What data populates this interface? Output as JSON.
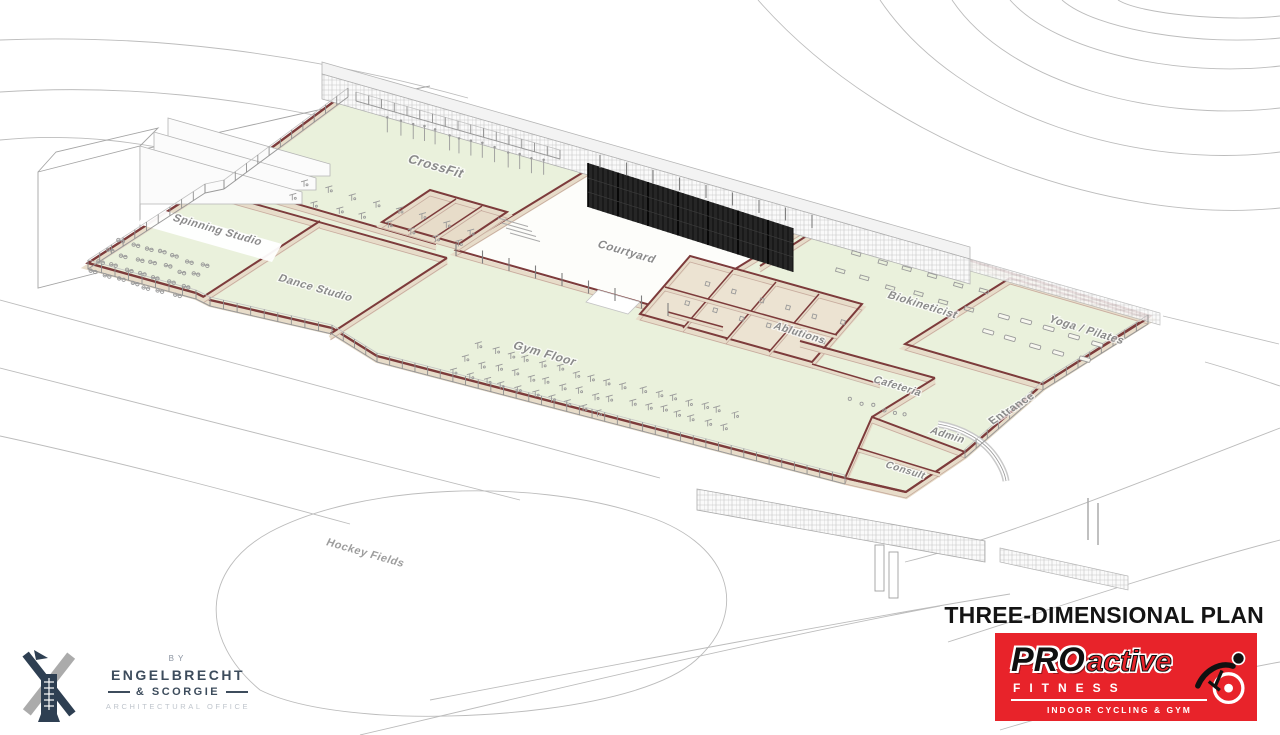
{
  "title_block": {
    "title": "THREE-DIMENSIONAL PLAN"
  },
  "brand": {
    "name_bold": "PRO",
    "name_light": "active",
    "line2": "FITNESS",
    "tagline": "INDOOR CYCLING & GYM",
    "bg_color": "#e8232a"
  },
  "architect": {
    "pre": "BY",
    "line1": "ENGELBRECHT",
    "line2": "& SCORGIE",
    "line3": "ARCHITECTURAL OFFICE"
  },
  "site": {
    "hockey_fields_label": "Hockey Fields"
  },
  "rooms": [
    {
      "id": "crossfit",
      "label": "CrossFit"
    },
    {
      "id": "spinning",
      "label": "Spinning Studio"
    },
    {
      "id": "dance",
      "label": "Dance Studio"
    },
    {
      "id": "gym",
      "label": "Gym Floor"
    },
    {
      "id": "courtyard",
      "label": "Courtyard"
    },
    {
      "id": "ablutions",
      "label": "Ablutions"
    },
    {
      "id": "biokineticist",
      "label": "Biokineticist"
    },
    {
      "id": "yoga",
      "label": "Yoga / Pilates"
    },
    {
      "id": "cafeteria",
      "label": "Cafeteria"
    },
    {
      "id": "entrance",
      "label": "Entrance"
    },
    {
      "id": "admin",
      "label": "Admin"
    },
    {
      "id": "consult",
      "label": "Consult"
    }
  ],
  "colors": {
    "floor": "#eaf1dc",
    "wall_face": "#e7dcc9",
    "wall_top": "#7d3b3b",
    "screen_dark": "#262626",
    "label_gray": "#8a8a8a",
    "contour_gray": "#bcbcbc",
    "brand_red": "#e8232a",
    "architect_navy": "#3d4c5c"
  }
}
